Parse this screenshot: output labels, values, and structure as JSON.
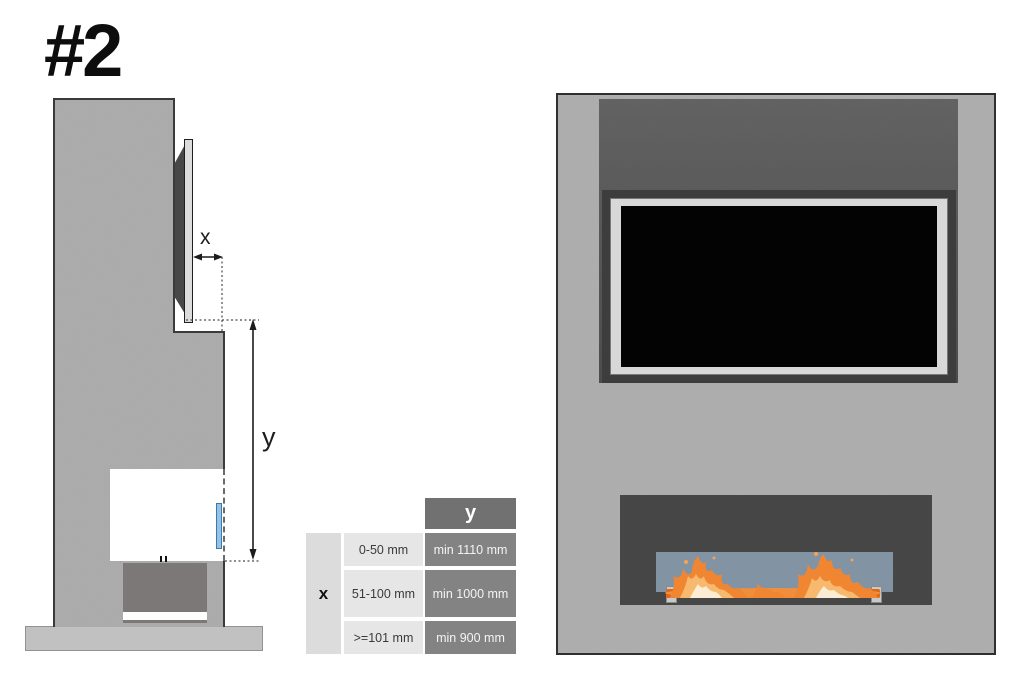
{
  "page": {
    "title": "#2"
  },
  "side_view": {
    "x_label": "x",
    "y_label": "y"
  },
  "clearance_table": {
    "corner_header": "x",
    "col_header": "y",
    "rows": [
      {
        "x_range": "0-50 mm",
        "y_min": "min 1110 mm"
      },
      {
        "x_range": "51-100 mm",
        "y_min": "min 1000 mm"
      },
      {
        "x_range": ">=101 mm",
        "y_min": "min 900 mm"
      }
    ]
  },
  "colors": {
    "wall_gray": "#ababab",
    "recess_gray": "#565656",
    "tv_frame_silver": "#d8d8d8",
    "screen_black": "#030303",
    "opening_dark": "#454545",
    "glass_front_blue": "#8b9eb2",
    "glass_side_blue": "#92c3e8",
    "flame_orange": "#f08632",
    "table_dark_cell": "#838383",
    "table_light_cell": "#e6e6e6"
  }
}
